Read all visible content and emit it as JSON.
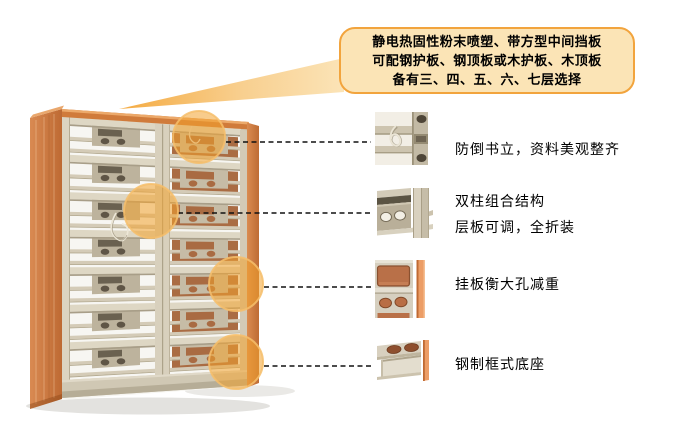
{
  "callout": {
    "lines": [
      "静电热固性粉末喷塑、带方型中间挡板",
      "可配钢护板、钢顶板或木护板、木顶板",
      "备有三、四、五、六、七层选择"
    ],
    "fill_color": "#FBE4B6",
    "border_color": "#F2A43D"
  },
  "annotations": [
    {
      "id": "book-support",
      "lines": [
        "防倒书立，资料美观整齐"
      ]
    },
    {
      "id": "double-column",
      "lines": [
        "双柱组合结构",
        "层板可调，全折装"
      ]
    },
    {
      "id": "hanging-plate",
      "lines": [
        "挂板衡大孔减重"
      ]
    },
    {
      "id": "steel-base",
      "lines": [
        "钢制框式底座"
      ]
    }
  ],
  "colors": {
    "accent_orange": "#F2A43D",
    "highlight_circle": "#F3A32E",
    "wood": "#C97540",
    "steel": "#CDC4B0",
    "connector_line": "#111111"
  }
}
